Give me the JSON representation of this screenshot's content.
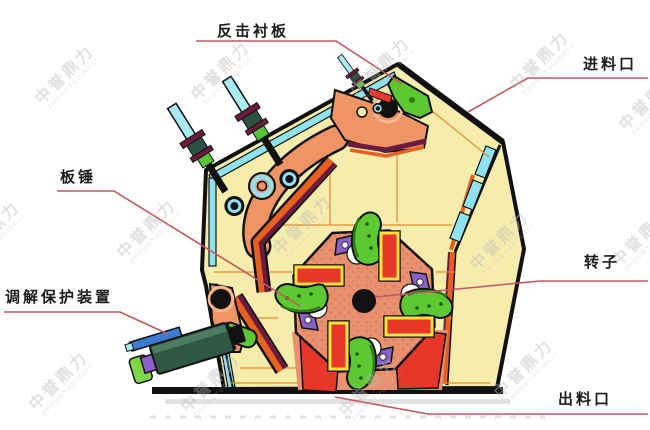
{
  "labels": {
    "impact_liner": "反击衬板",
    "feed_inlet": "进料口",
    "blow_bar": "板锤",
    "protection_device": "调解保护装置",
    "rotor": "转子",
    "discharge_outlet": "出料口"
  },
  "watermark": {
    "text": "中誉鼎力",
    "subtext": "ZHONGYUDINGLI"
  },
  "colors": {
    "leader_line": "#c25663",
    "label_text": "#1c1c1c",
    "housing_cream": "#f6edad",
    "lining_cyan": "#8fe2ef",
    "rack_salmon": "#ef9465",
    "liner_maroon": "#6b1b3e",
    "liner_orange": "#e8601f",
    "hammer_red": "#e6372a",
    "hammer_yellow": "#ffe23f",
    "hammer_green": "#5ec832",
    "accent_purple": "#8a5fc8",
    "device_green": "#2f5844",
    "device_blue": "#3b7bd0",
    "rotor_salmon": "#e9906e",
    "grid_orange": "#e8882d",
    "bolt_cyan": "#a8e9f2",
    "watermark_gray": "#b9b9b9"
  }
}
